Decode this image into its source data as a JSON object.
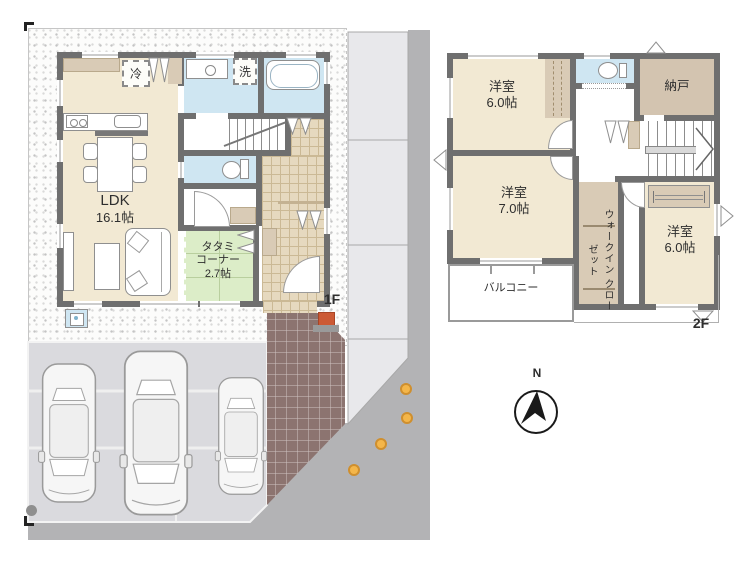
{
  "floor1": {
    "floor_label": "1F",
    "ldk": {
      "name": "LDK",
      "area": "16.1帖"
    },
    "tatami_corner": {
      "name_line1": "タタミ",
      "name_line2": "コーナー",
      "area": "2.7帖"
    },
    "refrigerator": "冷",
    "washer": "洗"
  },
  "floor2": {
    "floor_label": "2F",
    "bedroom_nw": {
      "name": "洋室",
      "area": "6.0帖"
    },
    "bedroom_sw": {
      "name": "洋室",
      "area": "7.0帖"
    },
    "bedroom_se": {
      "name": "洋室",
      "area": "6.0帖"
    },
    "storeroom": "納戸",
    "walk_in_closet": {
      "line1": "ウォークイン",
      "line2": "クローゼット"
    },
    "balcony": "バルコニー"
  },
  "compass": {
    "north_label": "N"
  },
  "site": {
    "parking_spaces": 3
  },
  "palette": {
    "wall": "#6f6f6f",
    "room_cream": "#f2e9d3",
    "tatami_green": "#dcedc8",
    "water_blue": "#cfe6f2",
    "closet_tan": "#d9cbb6",
    "road_gray": "#b3b3b5",
    "parking_gray": "#dadade",
    "approach_tile": "#8c7470",
    "accent_dot": "#f4b64a"
  }
}
